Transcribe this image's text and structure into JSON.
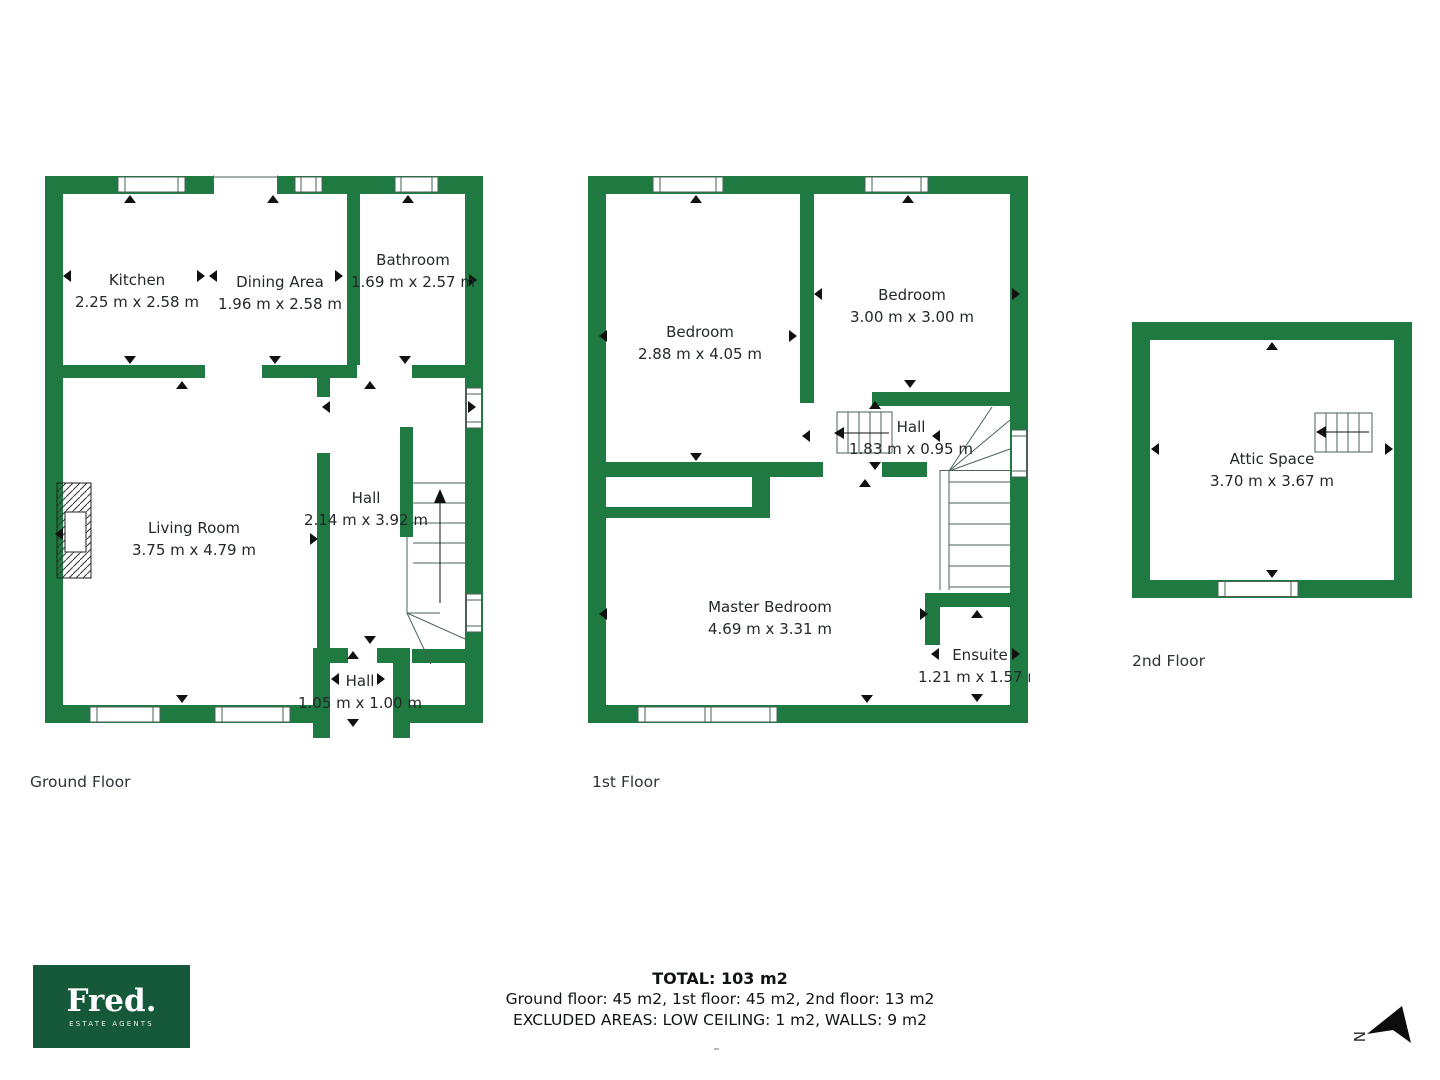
{
  "colors": {
    "wall_green": "#1e7a40",
    "logo_green": "#15583a",
    "detail_line": "#4a6356",
    "arrow_black": "#111111",
    "text": "#24282b"
  },
  "floors": {
    "ground": {
      "label": "Ground Floor",
      "rooms": {
        "kitchen": {
          "name": "Kitchen",
          "dims": "2.25 m x 2.58 m"
        },
        "dining": {
          "name": "Dining Area",
          "dims": "1.96 m x 2.58 m"
        },
        "bathroom": {
          "name": "Bathroom",
          "dims": "1.69 m x 2.57 m"
        },
        "living": {
          "name": "Living Room",
          "dims": "3.75 m x 4.79 m"
        },
        "hall": {
          "name": "Hall",
          "dims": "2.14 m x 3.92 m"
        },
        "entry_hall": {
          "name": "Hall",
          "dims": "1.05 m x 1.00 m"
        }
      }
    },
    "first": {
      "label": "1st Floor",
      "rooms": {
        "bedroom_left": {
          "name": "Bedroom",
          "dims": "2.88 m x 4.05 m"
        },
        "bedroom_right": {
          "name": "Bedroom",
          "dims": "3.00 m x 3.00 m"
        },
        "hall": {
          "name": "Hall",
          "dims": "1.83 m x 0.95 m"
        },
        "master": {
          "name": "Master Bedroom",
          "dims": "4.69 m x 3.31 m"
        },
        "ensuite": {
          "name": "Ensuite",
          "dims": "1.21 m x 1.57 m"
        }
      }
    },
    "second": {
      "label": "2nd Floor",
      "rooms": {
        "attic": {
          "name": "Attic Space",
          "dims": "3.70 m x 3.67 m"
        }
      }
    }
  },
  "summary": {
    "total": "TOTAL: 103 m2",
    "floors_line": "Ground floor: 45 m2, 1st floor: 45 m2, 2nd floor: 13 m2",
    "excluded_line": "EXCLUDED AREAS: LOW CEILING: 1 m2, WALLS: 9 m2"
  },
  "logo": {
    "name": "Fred.",
    "tagline": "ESTATE AGENTS"
  },
  "compass": {
    "label": "N"
  }
}
